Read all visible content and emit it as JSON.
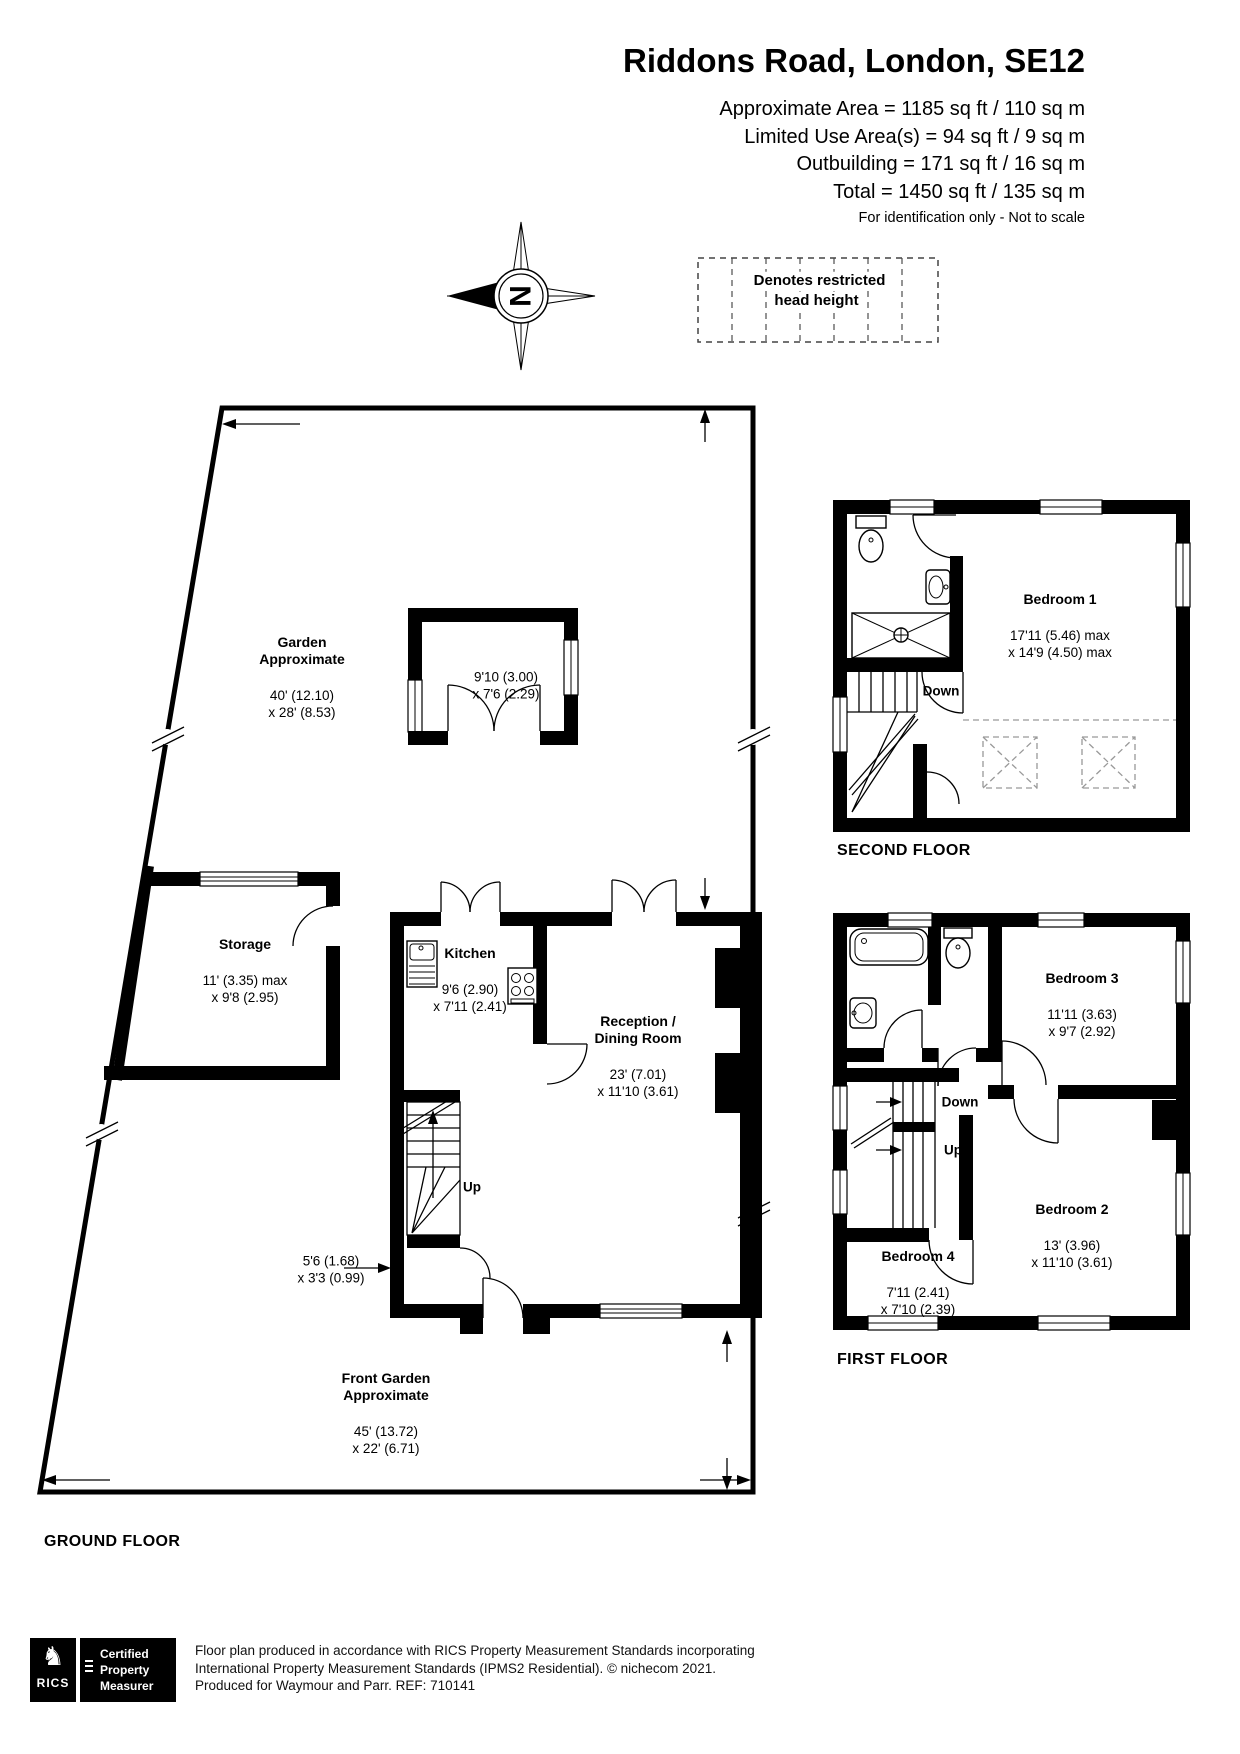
{
  "header": {
    "title": "Riddons Road, London, SE12",
    "area_lines": [
      "Approximate Area = 1185 sq ft / 110 sq m",
      "Limited Use Area(s) = 94 sq ft / 9 sq m",
      "Outbuilding = 171 sq ft / 16 sq m",
      "Total = 1450 sq ft / 135 sq m"
    ],
    "disclaimer": "For identification only - Not to scale"
  },
  "legend": {
    "note": "Denotes restricted\nhead height"
  },
  "compass": {
    "north_letter": "N"
  },
  "ground_floor": {
    "floor_label": "GROUND FLOOR",
    "stair_label": "Up",
    "rooms": {
      "garden": {
        "name": "Garden\nApproximate",
        "dims": "40' (12.10)\nx 28' (8.53)"
      },
      "outbuilding": {
        "dims": "9'10 (3.00)\nx 7'6 (2.29)"
      },
      "storage": {
        "name": "Storage",
        "dims": "11' (3.35) max\nx 9'8 (2.95)"
      },
      "kitchen": {
        "name": "Kitchen",
        "dims": "9'6 (2.90)\nx 7'11 (2.41)"
      },
      "reception": {
        "name": "Reception /\nDining Room",
        "dims": "23' (7.01)\nx 11'10 (3.61)"
      },
      "hall": {
        "dims": "5'6 (1.68)\nx 3'3 (0.99)"
      },
      "front_garden": {
        "name": "Front Garden\nApproximate",
        "dims": "45' (13.72)\nx 22' (6.71)"
      }
    }
  },
  "second_floor": {
    "floor_label": "SECOND FLOOR",
    "stair_label": "Down",
    "rooms": {
      "bedroom1": {
        "name": "Bedroom 1",
        "dims": "17'11 (5.46) max\nx 14'9 (4.50) max"
      }
    }
  },
  "first_floor": {
    "floor_label": "FIRST FLOOR",
    "stair_labels": {
      "down": "Down",
      "up": "Up"
    },
    "rooms": {
      "bedroom3": {
        "name": "Bedroom 3",
        "dims": "11'11 (3.63)\nx 9'7 (2.92)"
      },
      "bedroom2": {
        "name": "Bedroom 2",
        "dims": "13' (3.96)\nx 11'10 (3.61)"
      },
      "bedroom4": {
        "name": "Bedroom 4",
        "dims": "7'11 (2.41)\nx 7'10 (2.39)"
      }
    }
  },
  "footer": {
    "rics_brand": "RICS",
    "badge": "Certified\nProperty\nMeasurer",
    "lines": [
      "Floor plan produced in accordance with RICS Property Measurement Standards incorporating",
      "International Property Measurement Standards (IPMS2 Residential).  © nichecom 2021.",
      "Produced for Waymour and Parr.   REF:  710141"
    ]
  },
  "colors": {
    "wall": "#000000",
    "background": "#ffffff",
    "restricted_dash": "#999999"
  }
}
